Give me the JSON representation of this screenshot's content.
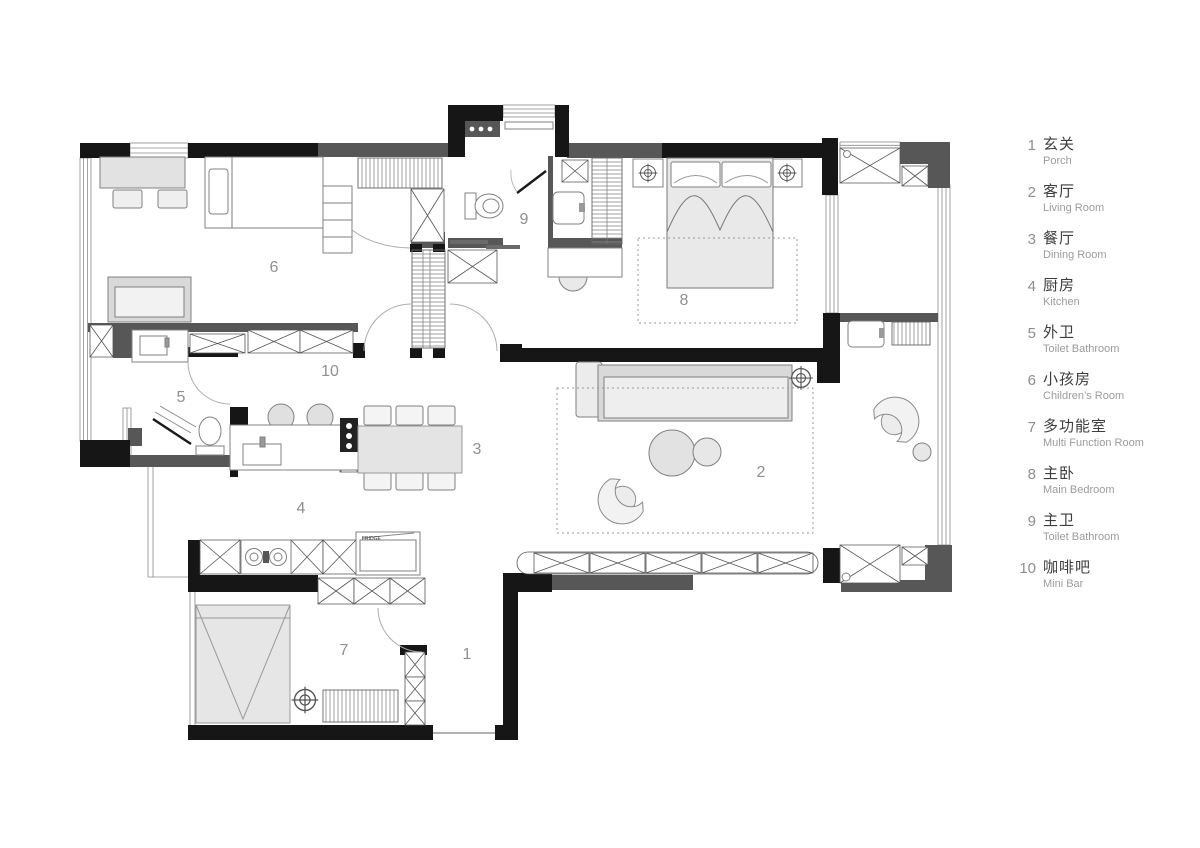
{
  "legend": {
    "items": [
      {
        "number": "1",
        "zh": "玄关",
        "en": "Porch"
      },
      {
        "number": "2",
        "zh": "客厅",
        "en": "Living Room"
      },
      {
        "number": "3",
        "zh": "餐厅",
        "en": "Dining Room"
      },
      {
        "number": "4",
        "zh": "厨房",
        "en": "Kitchen"
      },
      {
        "number": "5",
        "zh": "外卫",
        "en": "Toilet Bathroom"
      },
      {
        "number": "6",
        "zh": "小孩房",
        "en": "Children’s Room"
      },
      {
        "number": "7",
        "zh": "多功能室",
        "en": "Multi Function Room"
      },
      {
        "number": "8",
        "zh": "主卧",
        "en": "Main Bedroom"
      },
      {
        "number": "9",
        "zh": "主卫",
        "en": "Toilet Bathroom"
      },
      {
        "number": "10",
        "zh": "咖啡吧",
        "en": "Mini Bar"
      }
    ]
  },
  "plan": {
    "room_labels": [
      {
        "text": "1"
      },
      {
        "text": "2"
      },
      {
        "text": "3"
      },
      {
        "text": "4"
      },
      {
        "text": "5"
      },
      {
        "text": "6"
      },
      {
        "text": "7"
      },
      {
        "text": "8"
      },
      {
        "text": "9"
      },
      {
        "text": "10"
      }
    ],
    "appliances": {
      "fridge": "FRIDGE"
    }
  },
  "colors": {
    "wall_black": "#161616",
    "wall_gray": "#575757",
    "furniture_line": "#808080",
    "furniture_fill": "#e7e7e7",
    "label_text": "#8f8f8f"
  }
}
